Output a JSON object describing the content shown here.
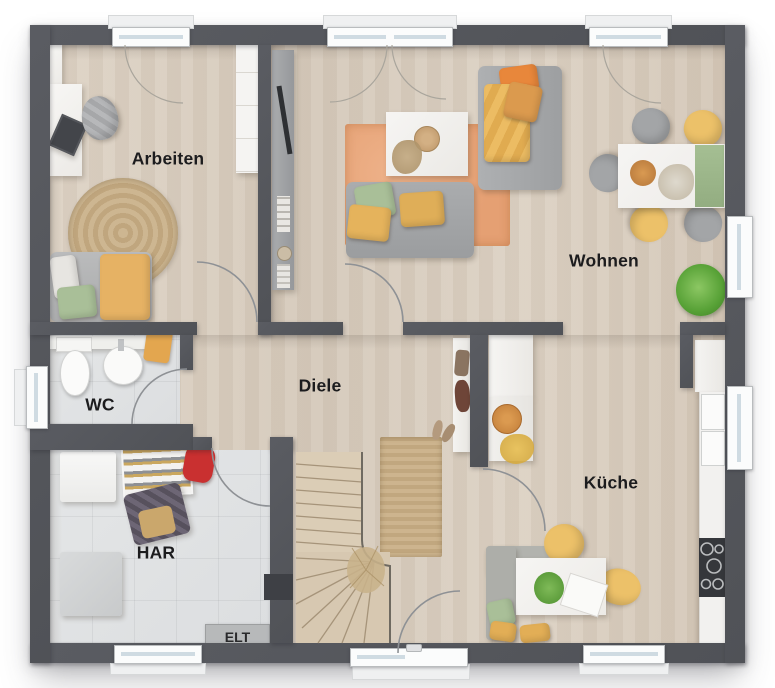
{
  "plan": {
    "type": "floor-plan",
    "rooms": [
      {
        "id": "arbeiten",
        "label": "Arbeiten"
      },
      {
        "id": "wohnen",
        "label": "Wohnen"
      },
      {
        "id": "diele",
        "label": "Diele"
      },
      {
        "id": "wc",
        "label": "WC"
      },
      {
        "id": "har",
        "label": "HAR"
      },
      {
        "id": "kueche",
        "label": "Küche"
      },
      {
        "id": "elt",
        "label": "ELT"
      }
    ],
    "colors": {
      "wall": "#55575c",
      "wood_floor": "#d8cdbf",
      "tile_floor": "#e0e2e3",
      "rug_orange": "#e9a87c",
      "jute": "#c9b08a",
      "sofa_gray": "#a6a8aa",
      "pillow_yellow": "#e6b264",
      "pillow_green": "#a9bf98",
      "pillow_orange": "#e8873b",
      "label_text": "#1c1c1e"
    }
  }
}
